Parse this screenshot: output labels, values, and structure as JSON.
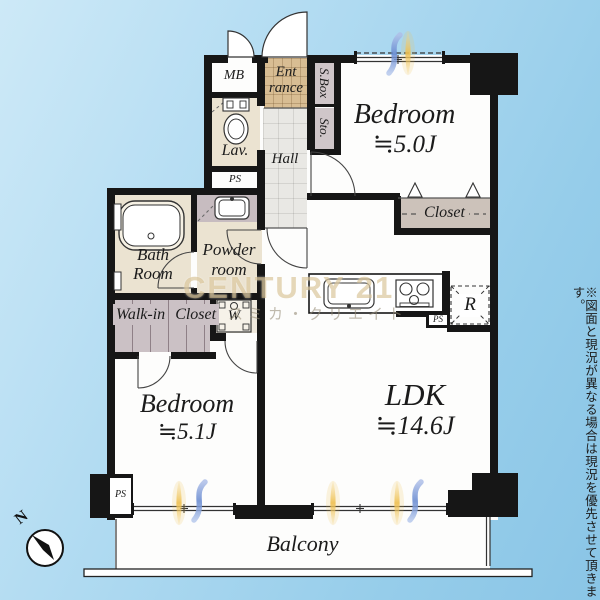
{
  "plan": {
    "watermark": {
      "brand": "CENTURY 21",
      "company": "スミカ・クリエイト"
    },
    "disclaimer": "※図面と現況が異なる場合は現況を優先させて頂きます。",
    "compass": {
      "north": "N"
    },
    "rooms": {
      "bedroom_a": {
        "label": "Bedroom",
        "size": "≒5.0J"
      },
      "bedroom_b": {
        "label": "Bedroom",
        "size": "≒5.1J"
      },
      "ldk": {
        "label": "LDK",
        "size": "≒14.6J"
      },
      "balcony": {
        "label": "Balcony"
      },
      "entrance": {
        "line1": "Ent",
        "line2": "rance"
      },
      "hall": {
        "label": "Hall"
      },
      "lavatory": {
        "label": "Lav."
      },
      "meter_box": {
        "label": "MB"
      },
      "pipe_space": {
        "label": "PS"
      },
      "storage": {
        "label": "Sto."
      },
      "shoe_box": {
        "label": "S.Box"
      },
      "bath": {
        "line1": "Bath",
        "line2": "Room"
      },
      "powder": {
        "line1": "Powder",
        "line2": "room"
      },
      "walk_in_closet": {
        "line1": "Walk-in",
        "line2": "Closet"
      },
      "closet": {
        "label": "Closet"
      },
      "washer": {
        "label": "W"
      },
      "refrigerator": {
        "label": "R"
      }
    },
    "colors": {
      "wall": "#161616",
      "sky_top": "#cde9f7",
      "sky_bottom": "#8ac5e6",
      "cream_room": "#ebe3d1",
      "entrance_tile": "#d8bd93",
      "hall_gray": "#e9e8e4",
      "closet_mauve": "#cbc1c5",
      "sunlight": "#eec255",
      "wind_blue": "#7596d4"
    }
  }
}
